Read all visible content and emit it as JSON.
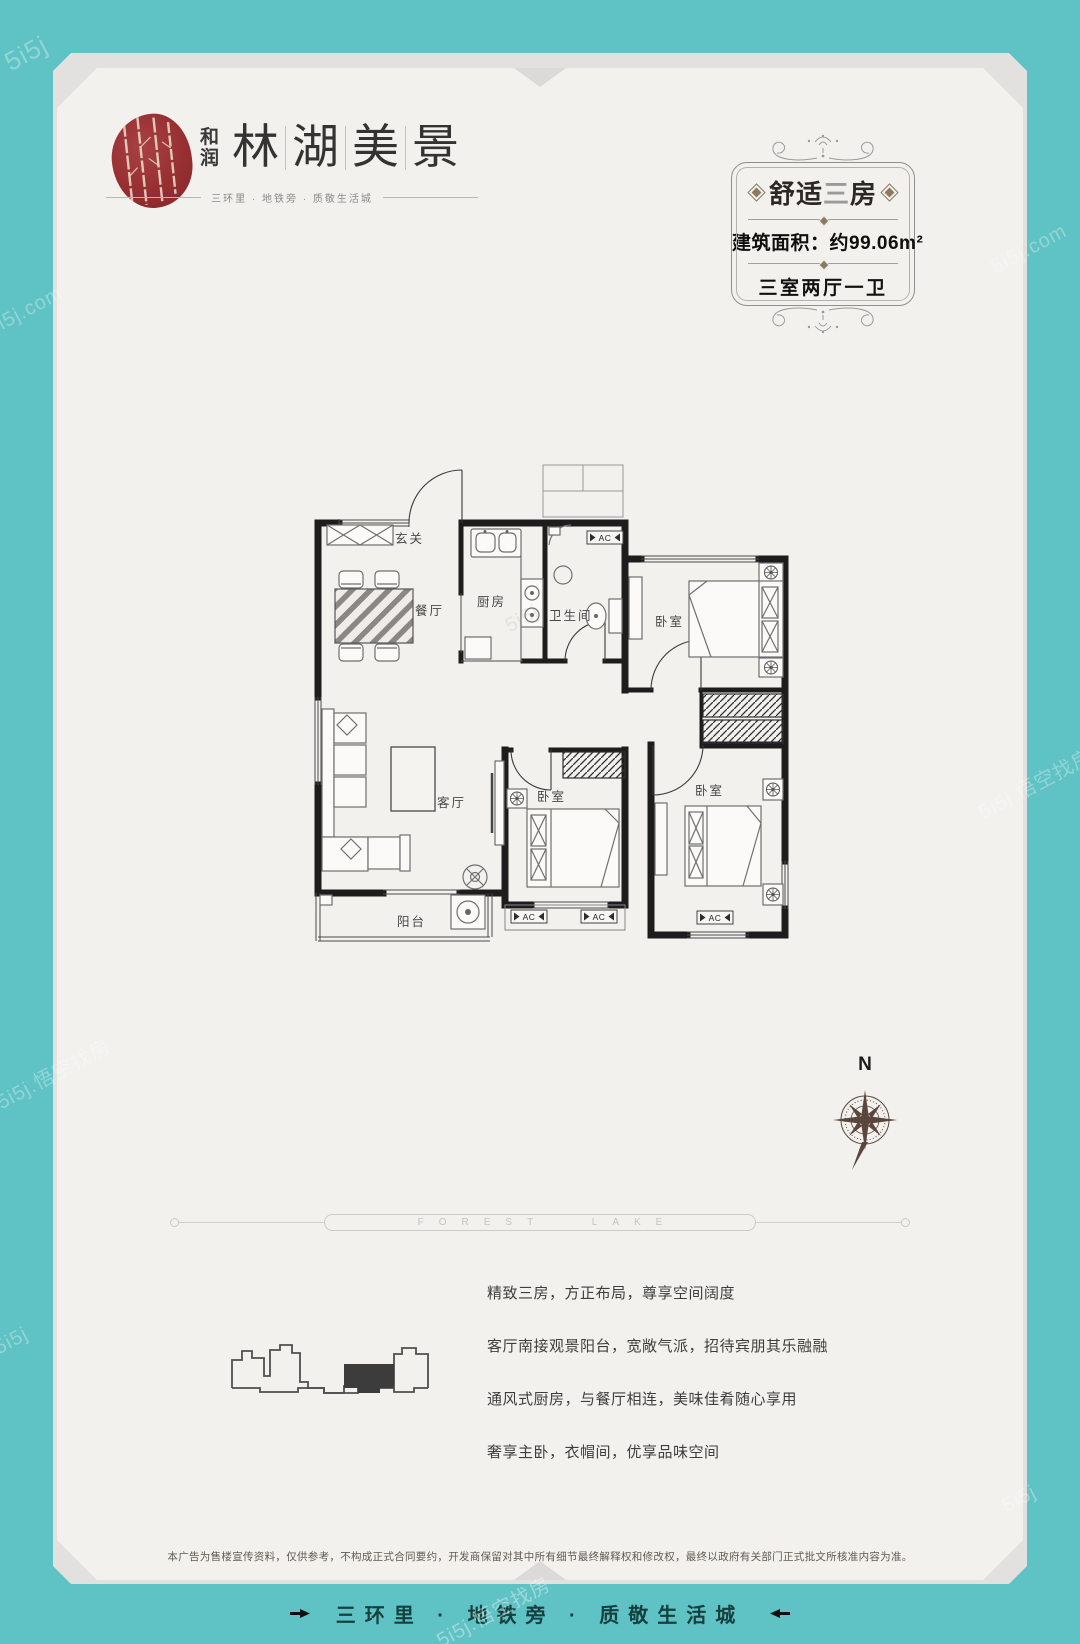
{
  "brand": {
    "name_small_chars": [
      "和",
      "润"
    ],
    "name_chars": [
      "林",
      "湖",
      "美",
      "景"
    ],
    "tagline": "三环里 · 地铁旁 · 质敬生活城"
  },
  "badge": {
    "title_parts": [
      "舒适",
      "三",
      "房"
    ],
    "area": "建筑面积：约99.06m²",
    "layout": "三室两厅一卫"
  },
  "floorplan": {
    "rooms": {
      "entry": "玄关",
      "dining": "餐厅",
      "kitchen": "厨房",
      "bath": "卫生间",
      "bedroom": "卧室",
      "living": "客厅",
      "balcony": "阳台"
    },
    "ac": "AC",
    "compass": "N"
  },
  "divider_text": "FOREST LAKE",
  "features": [
    "精致三房，方正布局，尊享空间阔度",
    "客厅南接观景阳台，宽敞气派，招待宾朋其乐融融",
    "通风式厨房，与餐厅相连，美味佳肴随心享用",
    "奢享主卧，衣帽间，优享品味空间"
  ],
  "disclaimer": "本广告为售楼宣传资料，仅供参考，不构成正式合同要约，开发商保留对其中所有细节最终解释权和修改权，最终以政府有关部门正式批文所核准内容为准。",
  "footer": "三环里 · 地铁旁 · 质敬生活城",
  "watermarks": {
    "short": "5i5j",
    "com": "5i5j.com",
    "full": "5i5j.悟空找房"
  },
  "colors": {
    "teal": "#5fc2c4",
    "card": "#f2f1ee",
    "logo_red": "#972f32",
    "wall": "#1d1d1d"
  }
}
